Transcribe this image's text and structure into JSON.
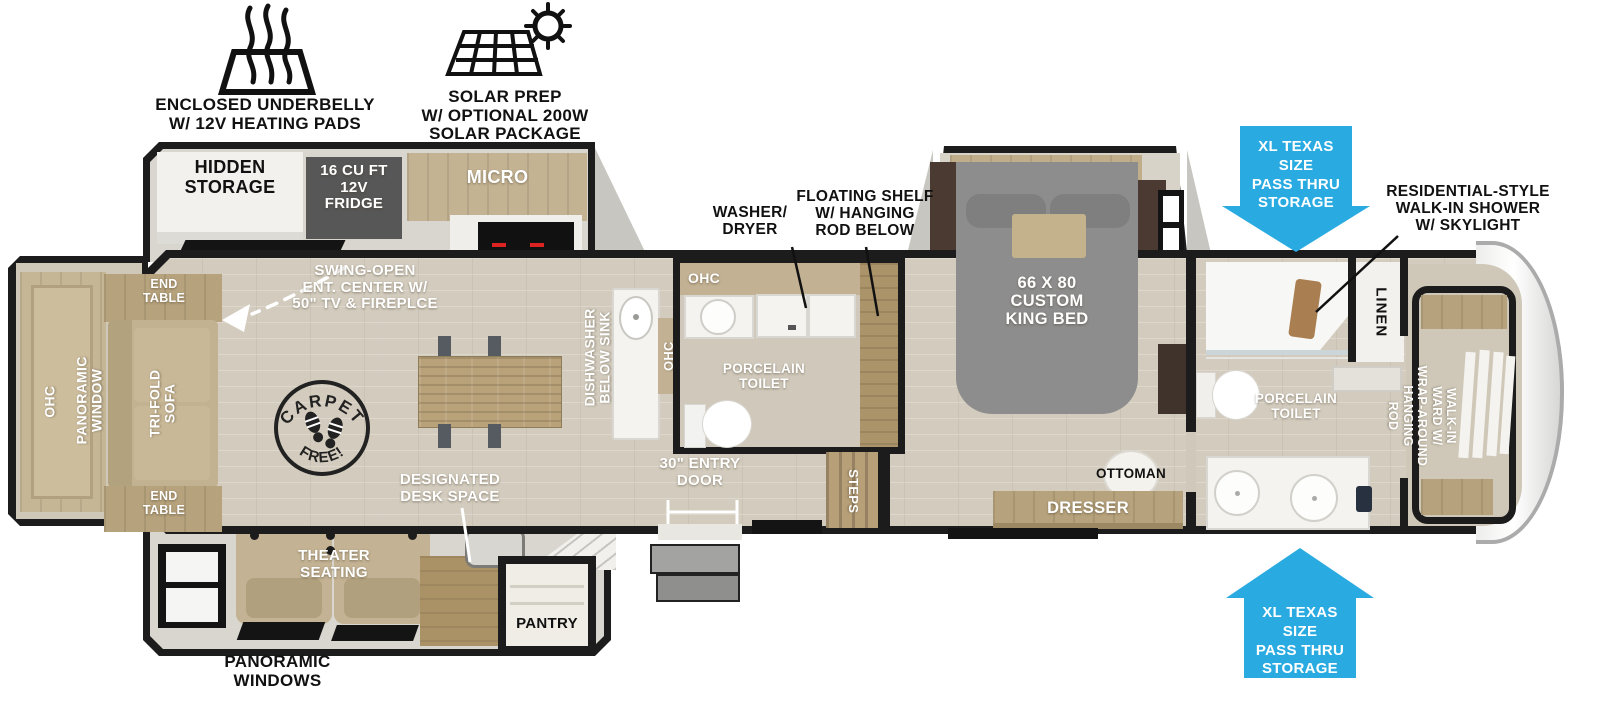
{
  "badges": {
    "underbelly": {
      "icon": "heating-pads-icon",
      "label": "ENCLOSED UNDERBELLY\nW/ 12V HEATING PADS"
    },
    "solar": {
      "icon": "solar-panel-icon",
      "label": "SOLAR PREP\nW/ OPTIONAL 200W\nSOLAR PACKAGE"
    }
  },
  "pass_thru_arrows": {
    "color": "#29abe2",
    "top_label": "XL TEXAS SIZE\nPASS THRU\nSTORAGE",
    "bottom_label": "XL TEXAS SIZE\nPASS THRU\nSTORAGE"
  },
  "callouts": {
    "shower": "RESIDENTIAL-STYLE\nWALK-IN SHOWER\nW/ SKYLIGHT",
    "washer_dryer": "WASHER/\nDRYER",
    "floating_shelf": "FLOATING SHELF\nW/ HANGING\nROD BELOW",
    "entertainment": "SWING-OPEN\nENT. CENTER W/\n50\" TV & FIREPLCE",
    "desk": "DESIGNATED\nDESK SPACE",
    "entry_door": "30\" ENTRY\nDOOR",
    "panoramic_windows": "PANORAMIC\nWINDOWS"
  },
  "living": {
    "hidden_storage": "HIDDEN\nSTORAGE",
    "fridge": "16 CU FT\n12V\nFRIDGE",
    "micro": "MICRO",
    "end_table_top": "END\nTABLE",
    "end_table_bottom": "END\nTABLE",
    "ohc": "OHC",
    "panoramic_window": "PANORAMIC\nWINDOW",
    "tri_fold_sofa": "TRI-FOLD\nSOFA",
    "theater": "THEATER\nSEATING",
    "pantry": "PANTRY",
    "carpet_stamp": {
      "top": "CARPET",
      "bottom": "FREE!"
    }
  },
  "kitchen": {
    "dishwasher": "DISHWASHER\nBELOW SINK",
    "ohc": "OHC"
  },
  "mid_bath": {
    "ohc": "OHC",
    "toilet": "PORCELAIN\nTOILET",
    "steps": "STEPS"
  },
  "bedroom": {
    "bed": "66 X 80\nCUSTOM\nKING BED",
    "ottoman": "OTTOMAN",
    "dresser": "DRESSER"
  },
  "front_bath": {
    "linen": "LINEN",
    "toilet": "PORCELAIN\nTOILET"
  },
  "wardrobe": {
    "label": "WALK-IN\nWARD W/\nWRAP-AROUND\nHANGING\nROD"
  }
}
